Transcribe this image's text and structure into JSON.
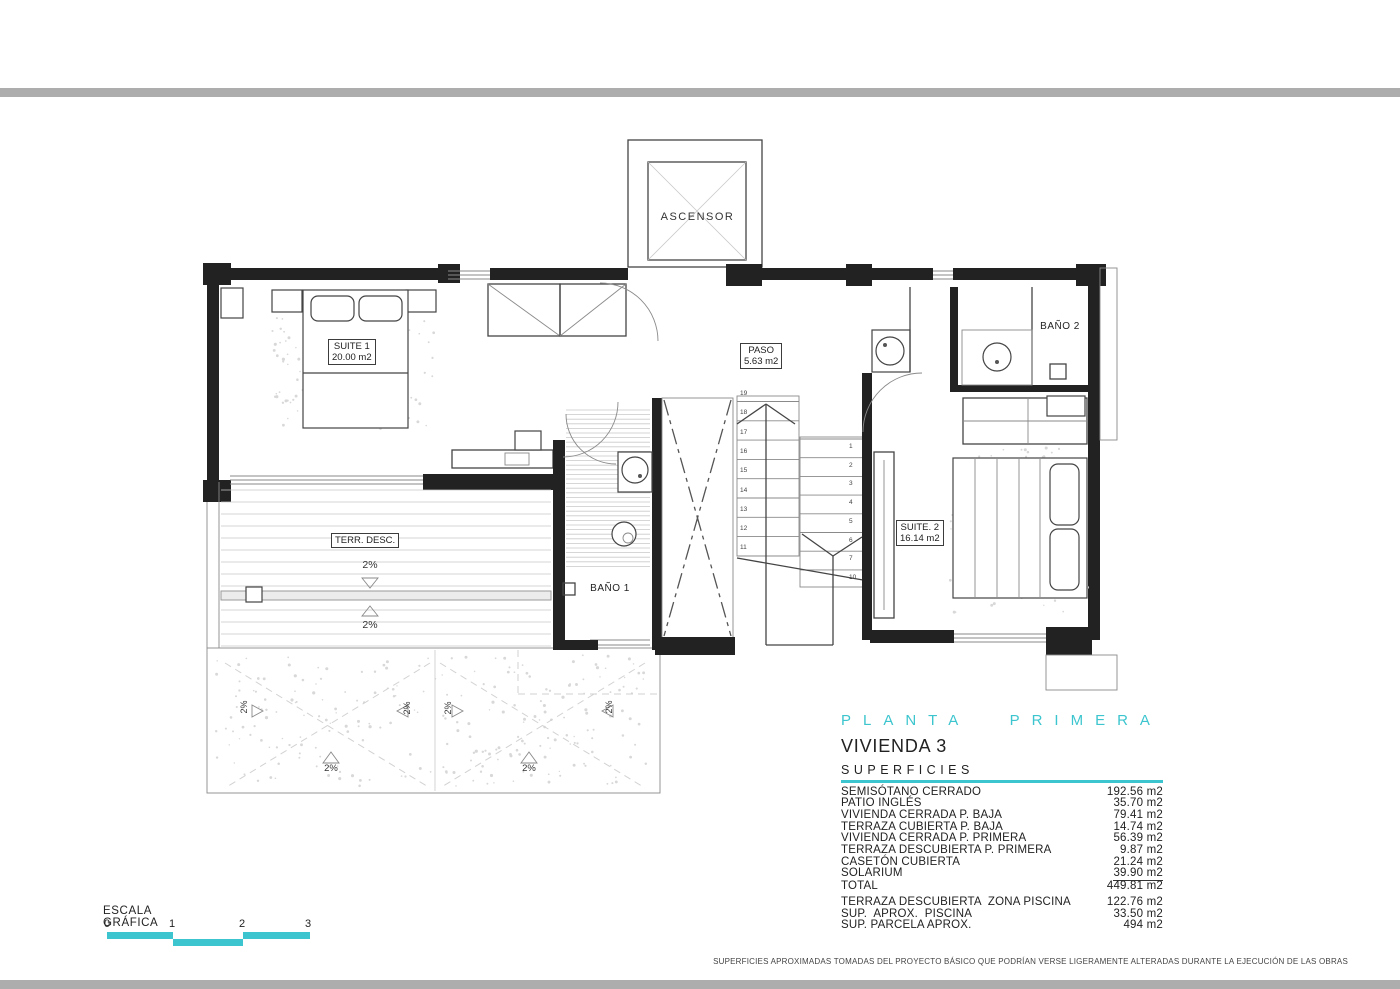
{
  "page": {
    "accent": "#3cc5ce",
    "bar_color": "#adadad"
  },
  "plan": {
    "elevator_label": "ASCENSOR",
    "suite1_name": "SUITE 1",
    "suite1_area": "20.00 m2",
    "paso_name": "PASO",
    "paso_area": "5.63 m2",
    "bano2_name": "BAÑO 2",
    "suite2_name": "SUITE. 2",
    "suite2_area": "16.14 m2",
    "terraza_name": "TERR. DESC.",
    "bano1_name": "BAÑO 1",
    "slope_label": "2%",
    "stairs": {
      "up_numbers": [
        "19",
        "18",
        "17",
        "16",
        "15",
        "14",
        "13",
        "12",
        "11"
      ],
      "down_numbers": [
        "1",
        "2",
        "3",
        "4",
        "5",
        "6",
        "7",
        "10"
      ]
    }
  },
  "title_block": {
    "floor_title": "PLANTA PRIMERA",
    "dwelling": "VIVIENDA 3",
    "surfaces_heading": "SUPERFICIES",
    "surfaces": [
      {
        "label": "SEMISÓTANO CERRADO",
        "value": "192.56 m2"
      },
      {
        "label": "PATIO INGLÉS",
        "value": "35.70 m2"
      },
      {
        "label": "VIVIENDA CERRADA P. BAJA",
        "value": "79.41 m2"
      },
      {
        "label": "TERRAZA CUBIERTA P. BAJA",
        "value": "14.74 m2"
      },
      {
        "label": "VIVIENDA CERRADA P. PRIMERA",
        "value": "56.39 m2"
      },
      {
        "label": "TERRAZA DESCUBIERTA P. PRIMERA",
        "value": "9.87 m2"
      },
      {
        "label": "CASETÓN CUBIERTA",
        "value": "21.24 m2"
      },
      {
        "label": "SOLARIUM",
        "value": "39.90 m2",
        "underline_value": true
      },
      {
        "label": "TOTAL",
        "value": "449.81 m2"
      }
    ],
    "extra_surfaces": [
      {
        "label": "TERRAZA DESCUBIERTA  ZONA PISCINA",
        "value": "122.76 m2"
      },
      {
        "label": "SUP.  APROX.  PISCINA",
        "value": "33.50 m2"
      },
      {
        "label": "SUP. PARCELA APROX.",
        "value": "494 m2"
      }
    ]
  },
  "scale_bar": {
    "label": "ESCALA GRÁFICA",
    "ticks": [
      "0",
      "1",
      "2",
      "3"
    ]
  },
  "footer": {
    "disclaimer": "SUPERFICIES APROXIMADAS TOMADAS DEL PROYECTO BÁSICO QUE PODRÍAN VERSE LIGERAMENTE ALTERADAS DURANTE LA EJECUCIÓN DE LAS OBRAS"
  }
}
